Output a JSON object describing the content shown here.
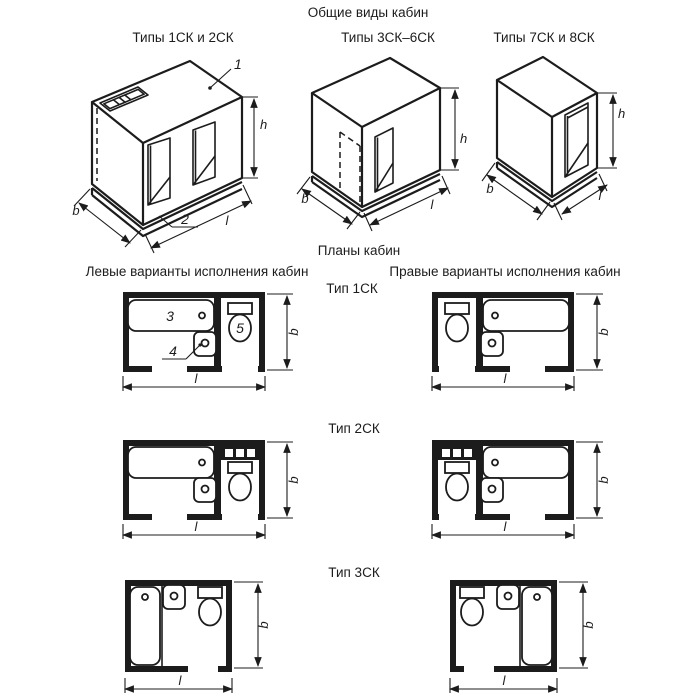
{
  "document": {
    "background": "#ffffff",
    "ink_color": "#1c1c1c"
  },
  "general_views": {
    "section_title": "Общие виды кабин",
    "views": [
      {
        "title": "Типы 1СК и 2СК",
        "callout_roof": "1",
        "callout_base": "2",
        "dim_width": "b",
        "dim_length": "l",
        "dim_height": "h"
      },
      {
        "title": "Типы 3СК–6СК",
        "dim_width": "b",
        "dim_length": "l",
        "dim_height": "h"
      },
      {
        "title": "Типы 7СК и 8СК",
        "dim_width": "b",
        "dim_length": "l",
        "dim_height": "h"
      }
    ]
  },
  "plans": {
    "section_title": "Планы кабин",
    "left_column_title": "Левые варианты исполнения кабин",
    "right_column_title": "Правые варианты исполнения кабин",
    "rows": [
      {
        "type_title": "Тип 1СК",
        "callout_bath": "3",
        "callout_washbasin": "4",
        "callout_toilet": "5",
        "left": {
          "dim_length": "l",
          "dim_width": "b"
        },
        "right": {
          "dim_length": "l",
          "dim_width": "b"
        }
      },
      {
        "type_title": "Тип 2СК",
        "left": {
          "dim_length": "l",
          "dim_width": "b"
        },
        "right": {
          "dim_length": "l",
          "dim_width": "b"
        }
      },
      {
        "type_title": "Тип 3СК",
        "left": {
          "dim_length": "l",
          "dim_width": "b"
        },
        "right": {
          "dim_length": "l",
          "dim_width": "b"
        }
      }
    ]
  }
}
